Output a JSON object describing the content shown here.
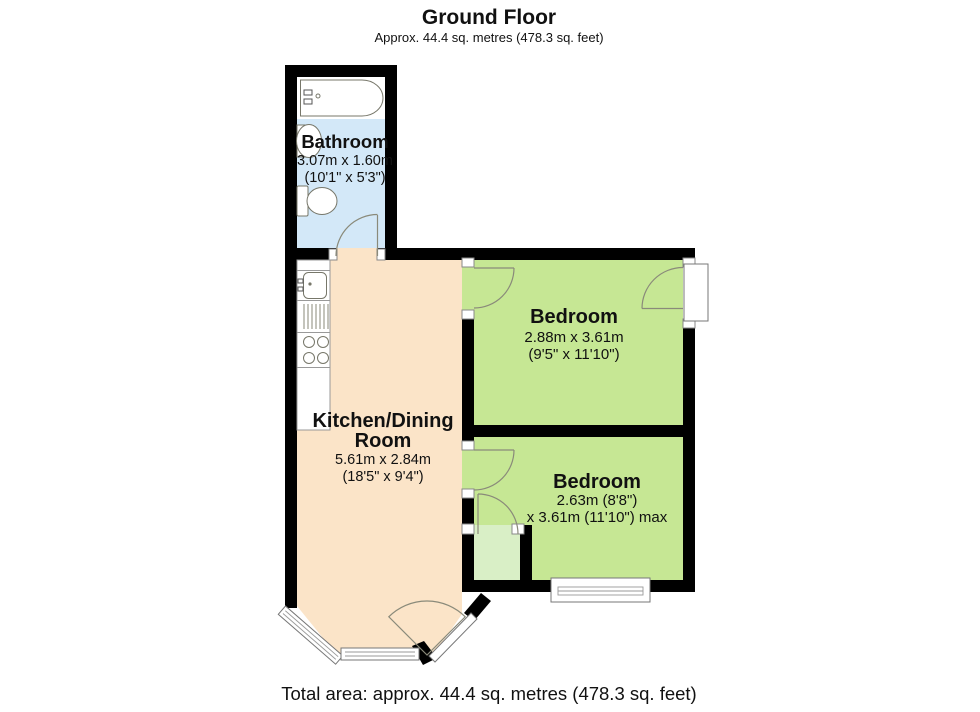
{
  "header": {
    "title": "Ground Floor",
    "subtitle": "Approx. 44.4 sq. metres (478.3 sq. feet)"
  },
  "footer": {
    "total_area": "Total area: approx. 44.4 sq. metres (478.3 sq. feet)"
  },
  "rooms": {
    "bathroom": {
      "name": "Bathroom",
      "dims_metric": "3.07m x 1.60m",
      "dims_imperial": "(10'1\" x 5'3\")",
      "floor_color": "#d3e8f8"
    },
    "kitchen": {
      "name_line1": "Kitchen/Dining",
      "name_line2": "Room",
      "dims_metric": "5.61m x 2.84m",
      "dims_imperial": "(18'5\" x 9'4\")",
      "floor_color": "#fbe4c8"
    },
    "bedroom1": {
      "name": "Bedroom",
      "dims_metric": "2.88m x 3.61m",
      "dims_imperial": "(9'5\" x 11'10\")",
      "floor_color": "#c6e794"
    },
    "bedroom2": {
      "name": "Bedroom",
      "dims_line1": "2.63m (8'8\")",
      "dims_line2": "x 3.61m (11'10\") max",
      "floor_color": "#c6e794"
    },
    "closet": {
      "floor_color": "#d9efc6"
    }
  },
  "colors": {
    "wall": "#000000",
    "fixture_stroke": "#77776a",
    "door_arc": "#8a8a7a",
    "text": "#111111"
  }
}
